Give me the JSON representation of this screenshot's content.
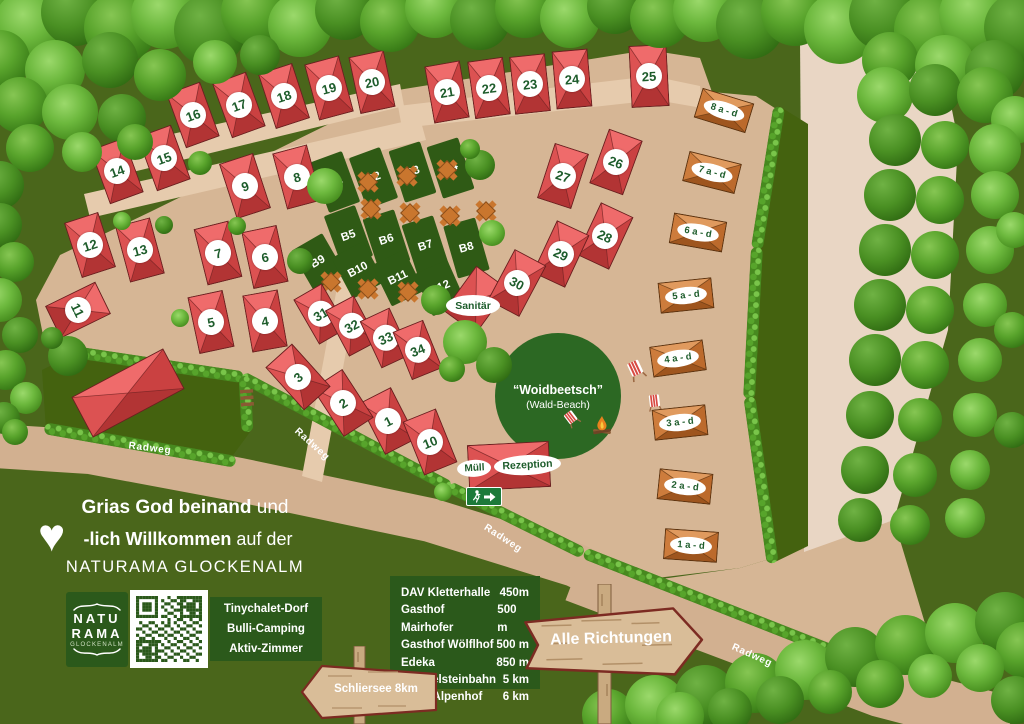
{
  "welcome": {
    "line1_bold": "Grias God beinand",
    "line1_rest": "und",
    "line2_bold": "-lich Willkommen",
    "line2_rest": "auf der",
    "line3": "NATURAMA GLOCKENALM"
  },
  "logo": {
    "top": "NATU",
    "bottom": "RAMA",
    "sub": "GLOCKENALM"
  },
  "amenities": {
    "line1": "Tinychalet-Dorf",
    "line2": "Bulli-Camping",
    "line3": "Aktiv-Zimmer"
  },
  "distances": {
    "rows": [
      {
        "name": "DAV Kletterhalle",
        "value": "450m"
      },
      {
        "name": "Gasthof Mairhofer",
        "value": "500 m"
      },
      {
        "name": "Gasthof Wölflhof",
        "value": "500 m"
      },
      {
        "name": "Edeka",
        "value": "850 m"
      },
      {
        "name": "Wendelsteinbahn",
        "value": "5 km"
      },
      {
        "name": "Hotel Alpenhof",
        "value": "6 km"
      }
    ]
  },
  "signs": {
    "alle_richtungen": "Alle Richtungen",
    "schliersee": "Schliersee 8km"
  },
  "labels": {
    "sanitaer": "Sanitär",
    "muell": "Müll",
    "rezeption": "Rezeption",
    "woidbeetsch": "“Woidbeetsch”",
    "wald_beach": "(Wald-Beach)",
    "radweg": "Radweg"
  },
  "cabins": {
    "red": [
      "1",
      "2",
      "3",
      "4",
      "5",
      "6",
      "7",
      "8",
      "9",
      "10",
      "11",
      "12",
      "13",
      "14",
      "15",
      "16",
      "17",
      "18",
      "19",
      "20",
      "21",
      "22",
      "23",
      "24",
      "25",
      "26",
      "27",
      "28",
      "29",
      "30",
      "31",
      "32",
      "33",
      "34"
    ],
    "tiny": [
      "8 a - d",
      "7 a - d",
      "6 a - d",
      "5 a - d",
      "4 a - d",
      "3 a - d",
      "2 a - d",
      "1 a - d"
    ],
    "pitches": [
      "B1",
      "B2",
      "B3",
      "B4",
      "B5",
      "B6",
      "B7",
      "B8",
      "B9",
      "B10",
      "B11",
      "B12"
    ]
  },
  "colors": {
    "cabin_red": "#dc5252",
    "tiny_orange": "#cd7c3c",
    "panel_green": "#2b591b",
    "path_tan": "#d6b695",
    "grass_green": "#4a661b",
    "hedge_green": "#57a42b",
    "text_green": "#1d5c2b"
  }
}
